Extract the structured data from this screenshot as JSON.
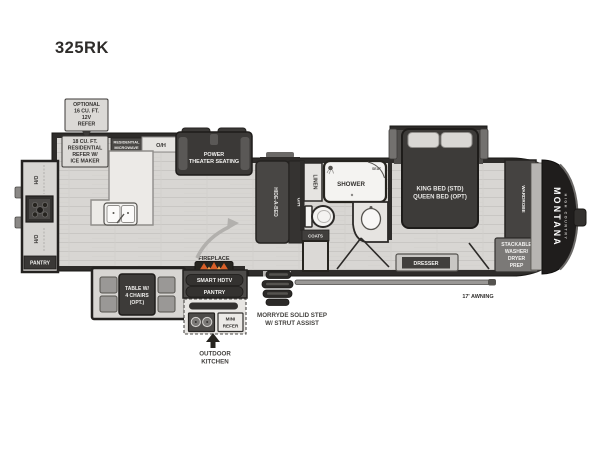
{
  "title": "325RK",
  "colors": {
    "wall": "#2e2c2a",
    "furniture_dark": "#3b3937",
    "floor": "#d8d6d3",
    "counter": "#eceae7",
    "label_box": "#dbd9d6",
    "flame_accent": "#d95f28",
    "text_dark": "#33312f",
    "text_light": "#f3f2f0"
  },
  "plan": {
    "model": "325RK",
    "callouts": {
      "optional_refer": [
        "OPTIONAL",
        "16 CU. FT.",
        "12V",
        "REFER"
      ],
      "residential_refer": [
        "18 CU. FT.",
        "RESIDENTIAL",
        "REFER W/",
        "ICE MAKER"
      ],
      "residential_microwave": [
        "RESIDENTIAL",
        "MICROWAVE"
      ],
      "morryde_step": [
        "MORRYDE SOLID STEP",
        "W/ STRUT ASSIST"
      ],
      "outdoor_kitchen": [
        "OUTDOOR",
        "KITCHEN"
      ],
      "awning": "17' AWNING"
    },
    "rooms": {
      "oh": "O/H",
      "pantry_rear": "PANTRY",
      "power_theater_seating": [
        "POWER",
        "THEATER SEATING"
      ],
      "hide_a_bed": "HIDE-A-BED",
      "linen": "LINEN",
      "shower": "SHOWER",
      "seat": "SEAT",
      "coats": "COATS",
      "bed": [
        "KING BED (STD)",
        "QUEEN BED (OPT)"
      ],
      "dresser": "DRESSER",
      "wardrobe": "WARDROBE",
      "stackable": [
        "STACKABLE",
        "WASHER/",
        "DRYER",
        "PREP"
      ],
      "fireplace": "FIREPLACE",
      "smart_hdtv": "SMART HDTV",
      "pantry_entertainment": "PANTRY",
      "table": [
        "TABLE W/",
        "4 CHAIRS",
        "(OPT.)"
      ],
      "mini_refer": [
        "MINI",
        "REFER"
      ]
    },
    "brand": {
      "name": "MONTANA",
      "sub": "HIGH COUNTRY"
    }
  }
}
